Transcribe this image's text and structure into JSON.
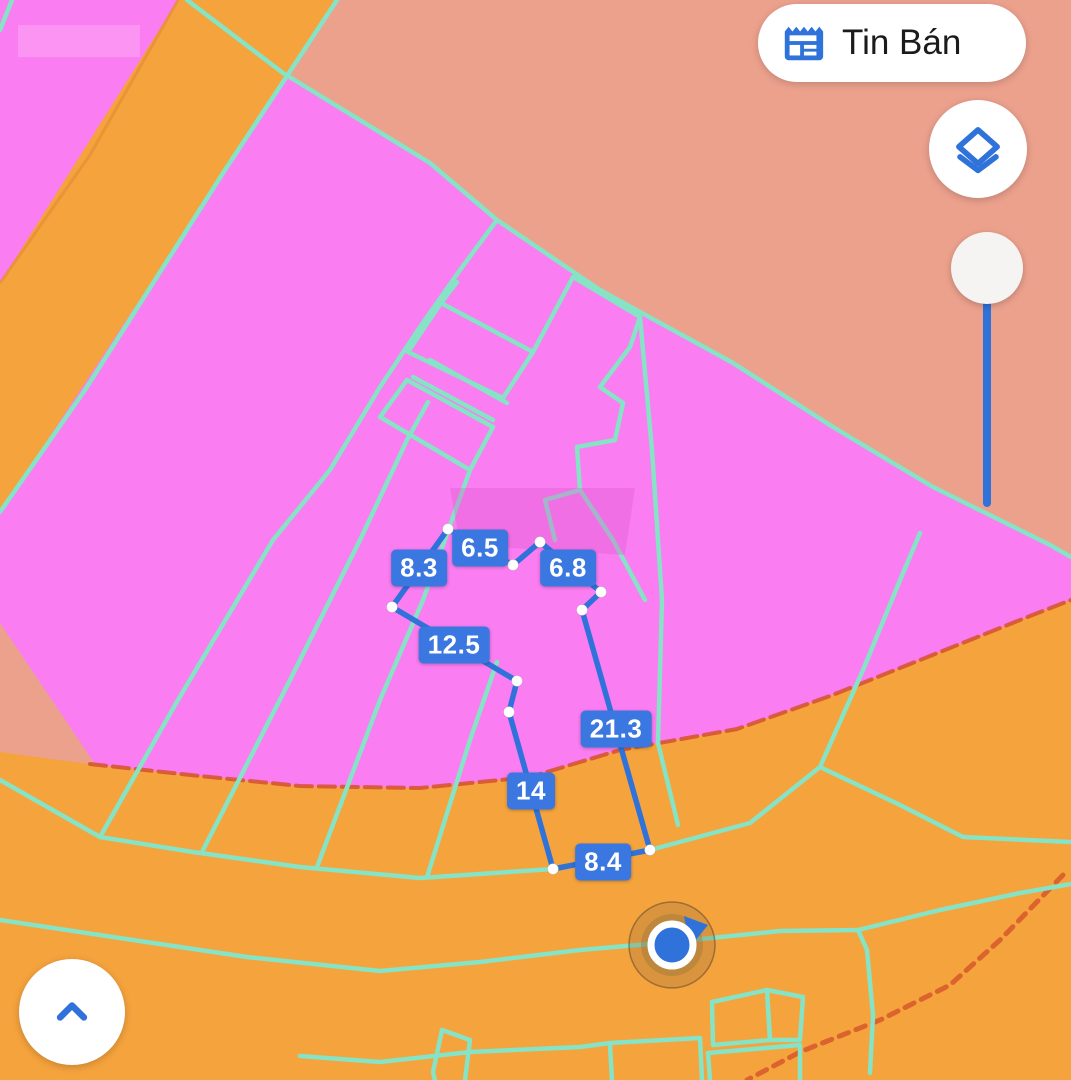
{
  "header": {
    "listings_button": {
      "label": "Tin Bán",
      "icon": "news-icon"
    }
  },
  "map_controls": {
    "layers_button": {
      "icon": "layers-icon"
    },
    "zoom_slider": {
      "orientation": "vertical",
      "knob_position": "top"
    },
    "expand_button": {
      "icon": "chevron-up-icon"
    }
  },
  "measurements": {
    "unit_note": "values shown on segment labels",
    "values": [
      "6.5",
      "8.3",
      "6.8",
      "12.5",
      "21.3",
      "14",
      "8.4"
    ]
  },
  "marker": {
    "type": "current-location",
    "heading": "north-east"
  },
  "colors": {
    "pink": "#fa7df1",
    "salmon": "#eca18d",
    "orange": "#f5a33d",
    "teal": "#86e3c6",
    "blue": "#2f73da",
    "chip-blue": "#3b77e0",
    "red-edge": "#d4522b"
  }
}
